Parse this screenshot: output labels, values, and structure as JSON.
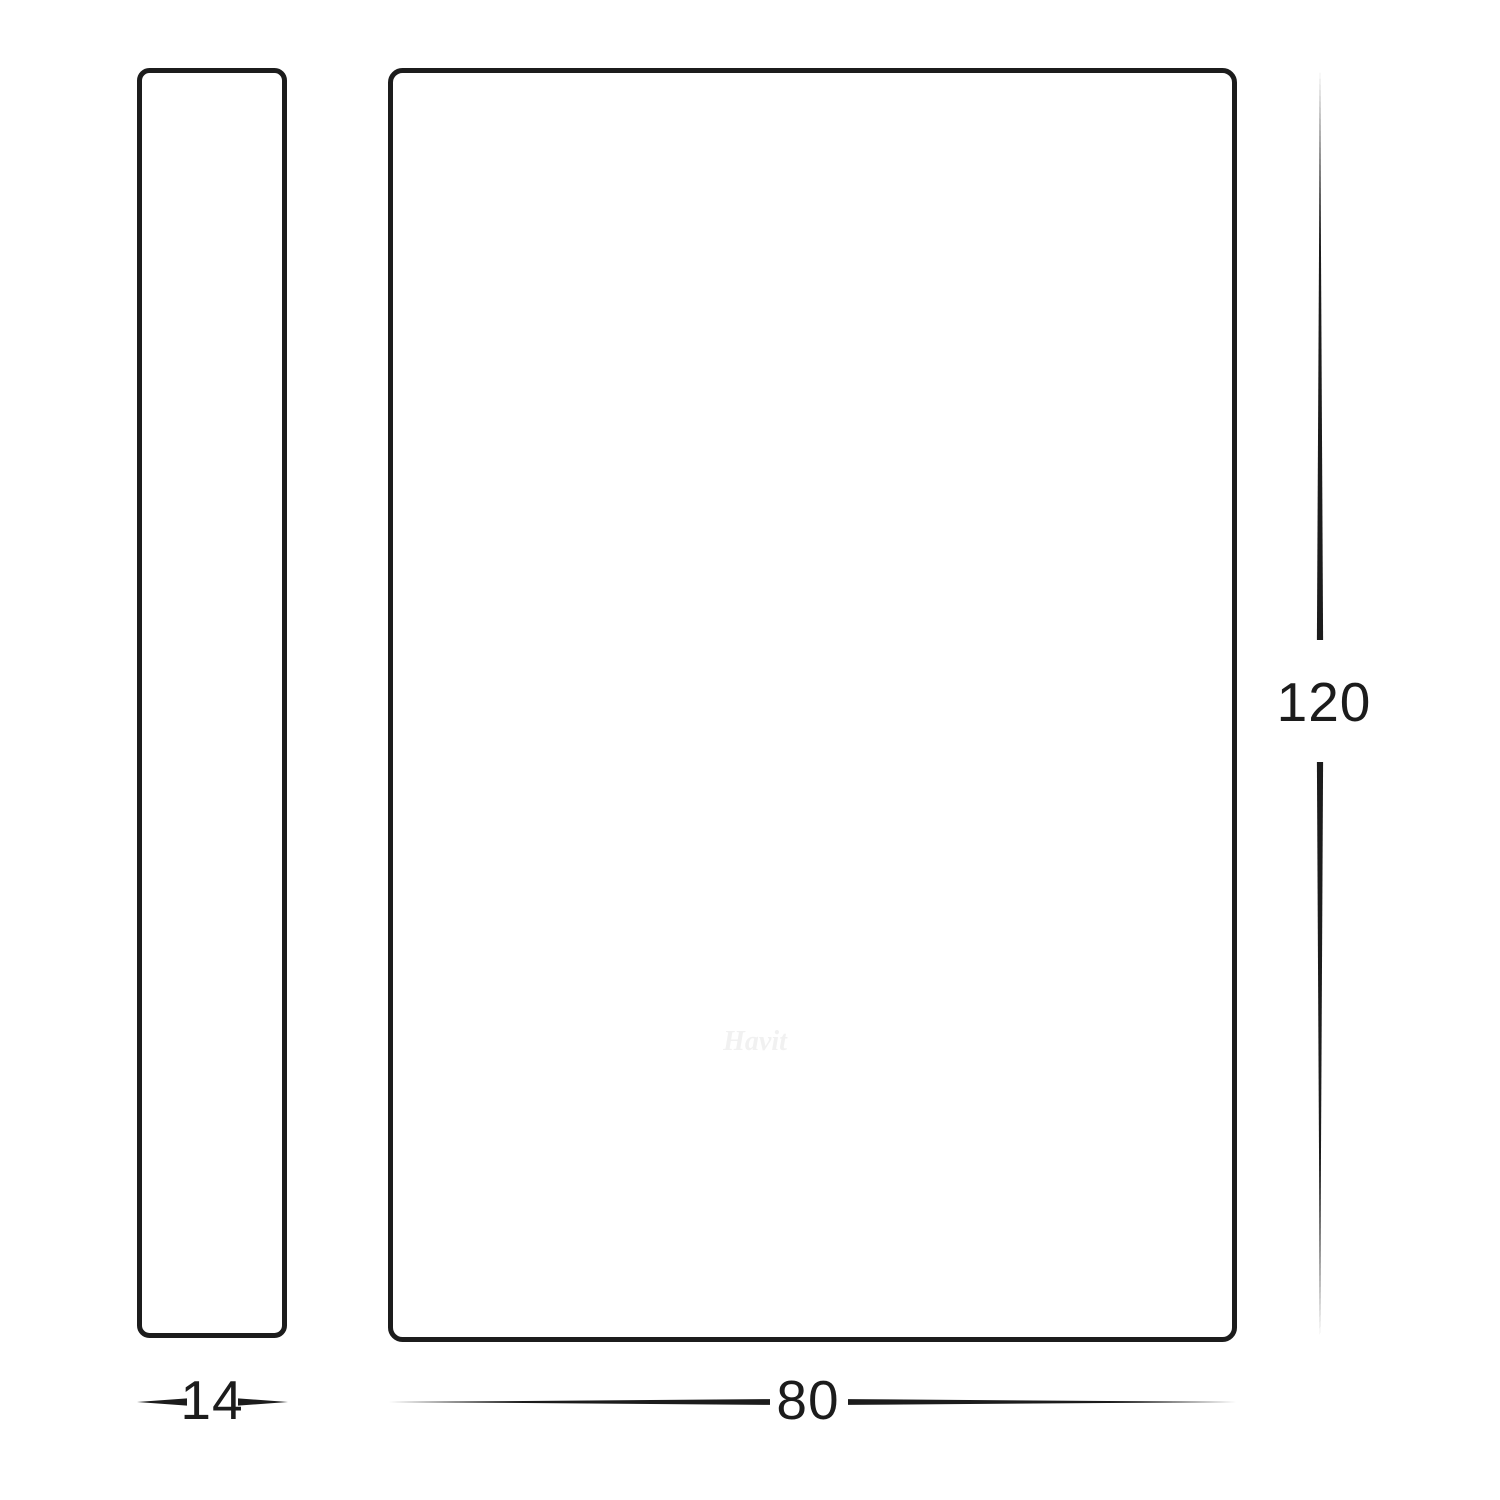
{
  "drawing": {
    "type": "technical-dimension-diagram",
    "background_color": "#ffffff",
    "line_color": "#1c1c1c",
    "text_color": "#1c1c1c",
    "views": [
      {
        "name": "side-profile-view",
        "shape": "tall thin rounded rectangle"
      },
      {
        "name": "front-face-view",
        "shape": "large rounded rectangle"
      }
    ]
  },
  "dimensions": {
    "side_width": "14",
    "front_width": "80",
    "front_height": "120"
  },
  "watermark": {
    "text": "Havit"
  }
}
